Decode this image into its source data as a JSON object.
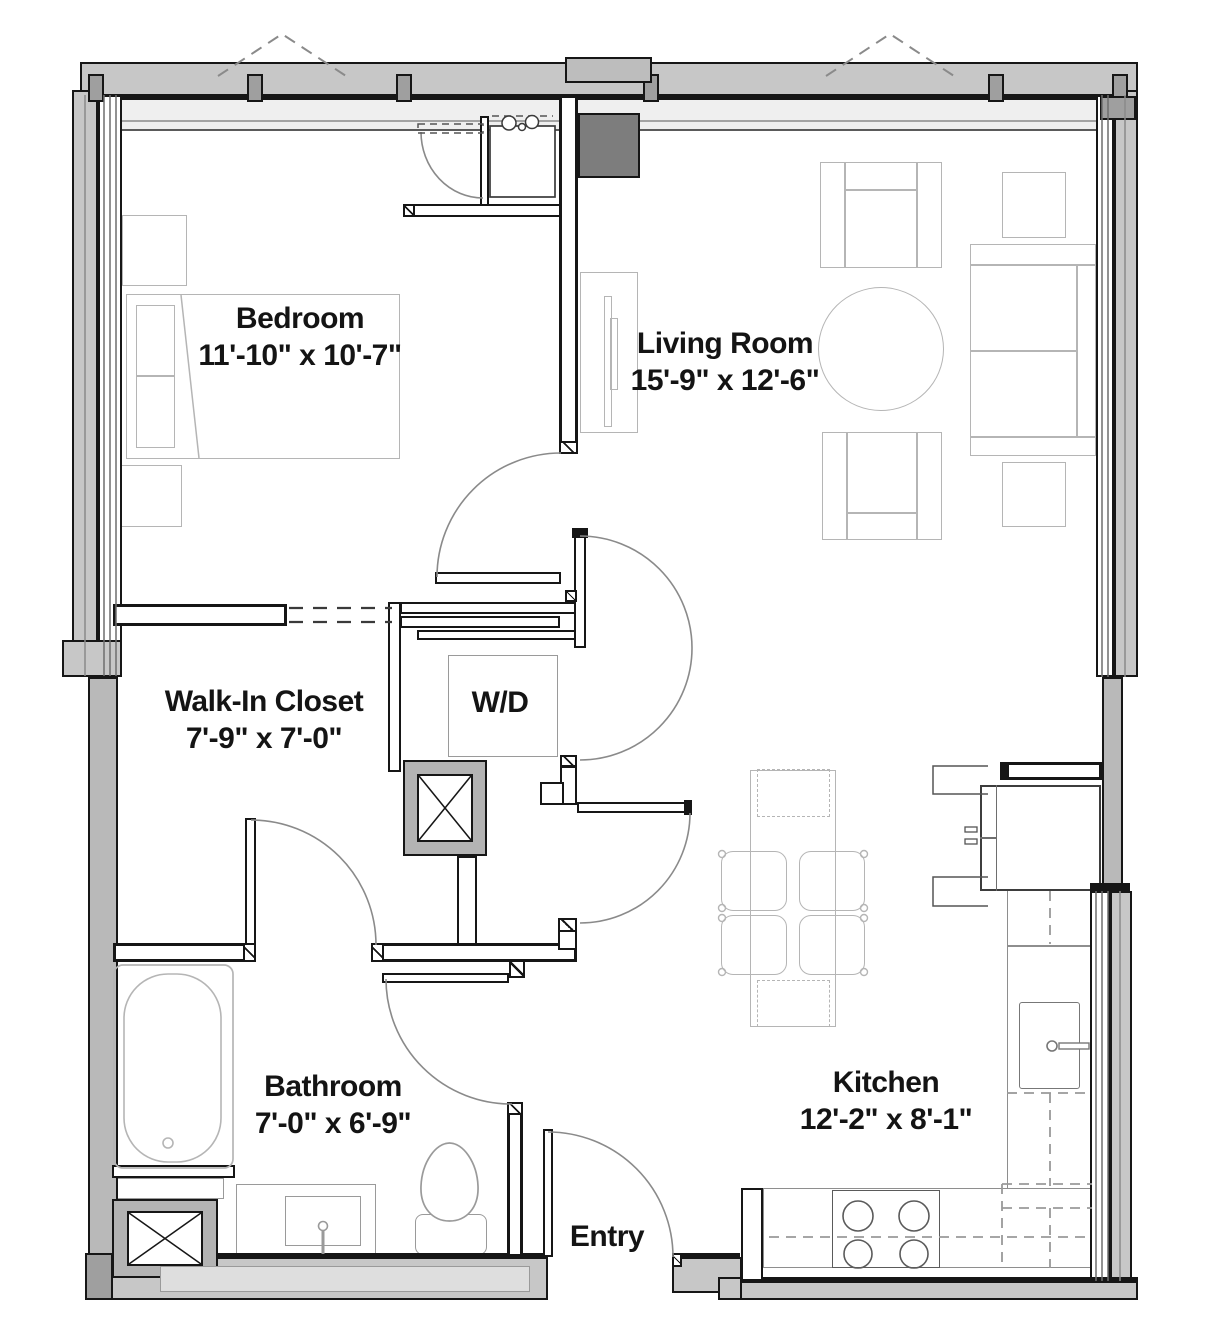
{
  "plan_title": "One-bedroom apartment floor plan",
  "rooms": [
    {
      "id": "bedroom",
      "name": "Bedroom",
      "dims": "11'-10\" x 10'-7\""
    },
    {
      "id": "living-room",
      "name": "Living Room",
      "dims": "15'-9\" x 12'-6\""
    },
    {
      "id": "walk-in-closet",
      "name": "Walk-In Closet",
      "dims": "7'-9\" x 7'-0\""
    },
    {
      "id": "bathroom",
      "name": "Bathroom",
      "dims": "7'-0\" x 6'-9\""
    },
    {
      "id": "kitchen",
      "name": "Kitchen",
      "dims": "12'-2\" x 8'-1\""
    }
  ],
  "labels": {
    "washer_dryer": "W/D",
    "entry": "Entry"
  },
  "colors": {
    "wall_core": "#ffffff",
    "wall_line": "#161616",
    "exterior_poche": "#c7c7c7",
    "chase_fill": "#7d7d7d",
    "furniture_line": "#b5b5b5",
    "door_arc": "#8a8a8a",
    "text": "#141414"
  }
}
